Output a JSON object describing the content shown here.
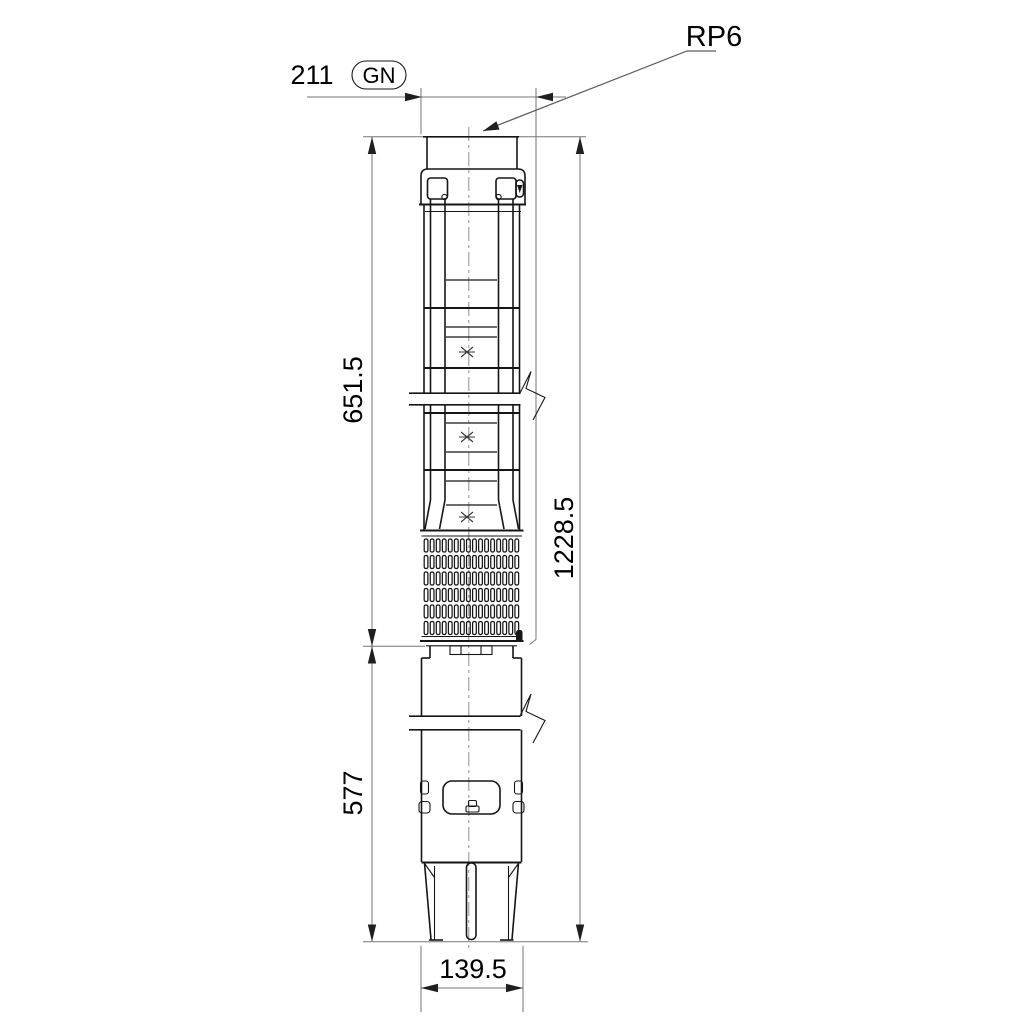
{
  "drawing": {
    "kind": "submersible-pump-dimensional-drawing",
    "labels": {
      "connection": "RP6",
      "gn": "GN",
      "dim_top_width": "211",
      "dim_pump_length": "651.5",
      "dim_total_length": "1228.5",
      "dim_motor_length": "577",
      "dim_diameter": "139.5"
    },
    "colors": {
      "background": "#ffffff",
      "object_line": "#161616",
      "dimension_line": "#767676",
      "text": "#000000"
    }
  }
}
